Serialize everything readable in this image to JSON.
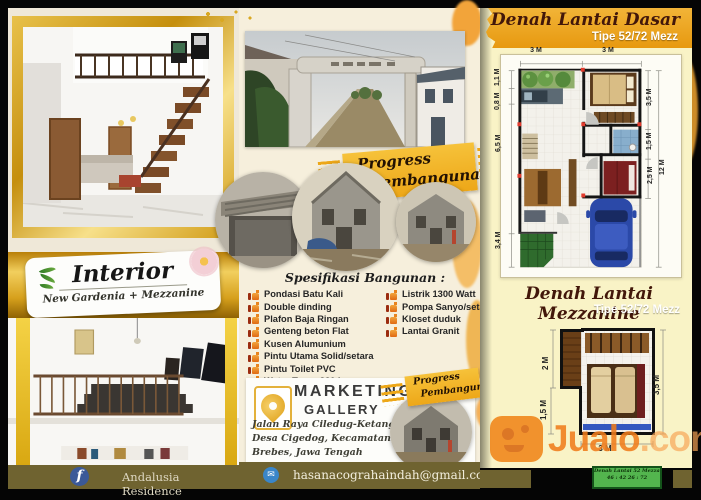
{
  "brand": {
    "watermark_name": "Jualo",
    "watermark_tld": ".com"
  },
  "left": {
    "banner_title": "Interior",
    "banner_subtitle": "New Gardenia + Mezzanine",
    "facebook_label": "Andalusia Residence"
  },
  "mid": {
    "ribbon1_line1": "Progress",
    "ribbon1_line2": "Pembangunan",
    "ribbon2_line1": "Progress",
    "ribbon2_line2": "Pembangunan",
    "spec_heading": "Spesifikasi Bangunan :",
    "spec_left": [
      "Pondasi Batu Kali",
      "Double dinding",
      "Plafon Baja Ringan",
      "Genteng beton Flat",
      "Kusen Alumunium",
      "Pintu Utama Solid/setara",
      "Pintu Toilet PVC",
      "Water Toren 320 L"
    ],
    "spec_right": [
      "Listrik 1300 Watt",
      "Pompa Sanyo/setara",
      "Kloset duduk",
      "Lantai Granit"
    ],
    "mk_title1": "MARKETING",
    "mk_title2": "GALLERY",
    "addr1": "Jalan Raya Ciledug-Ketanggungan,",
    "addr2": "Desa Cigedog, Kecamatan Kersana,",
    "addr3": "Brebes, Jawa Tengah",
    "email": "hasanacograhaindah@gmail.com"
  },
  "right": {
    "p1_title": "Denah Lantai Dasar",
    "p1_subtitle": "Tipe 52/72 Mezz",
    "p1_dims": {
      "t1": "3 M",
      "t2": "3 M",
      "l1": "1,1 M",
      "l2": "0,8 M",
      "l3": "6,5 M",
      "l4": "3,4 M",
      "r1": "3,5 M",
      "r2": "1,5 M",
      "r3": "2,5 M",
      "ro": "12 M"
    },
    "p2_title": "Denah Lantai Mezzanine",
    "p2_subtitle": "Tipe 52/72 Mezz",
    "p2_dims": {
      "l1": "2 M",
      "l2": "1,5 M",
      "r1": "3,5 M",
      "b1": "3 M"
    },
    "badge1": "Denah Lantai 52 Mezzanine",
    "badge2": "46 : 42 26 : 72"
  },
  "icons": {
    "facebook": "f",
    "email": "✉"
  },
  "colors": {
    "header_gold": "#EC9F1C",
    "page_yellow": "#F9F3C6",
    "page_cream": "#F6EFDC",
    "olive_bar": "#6F6330",
    "ribbon_gold": "#F2AF25",
    "jualo_orange": "#F0811C",
    "badge_green": "#53B54E",
    "car_blue": "#2B49A8",
    "bed_red": "#7C2020"
  }
}
